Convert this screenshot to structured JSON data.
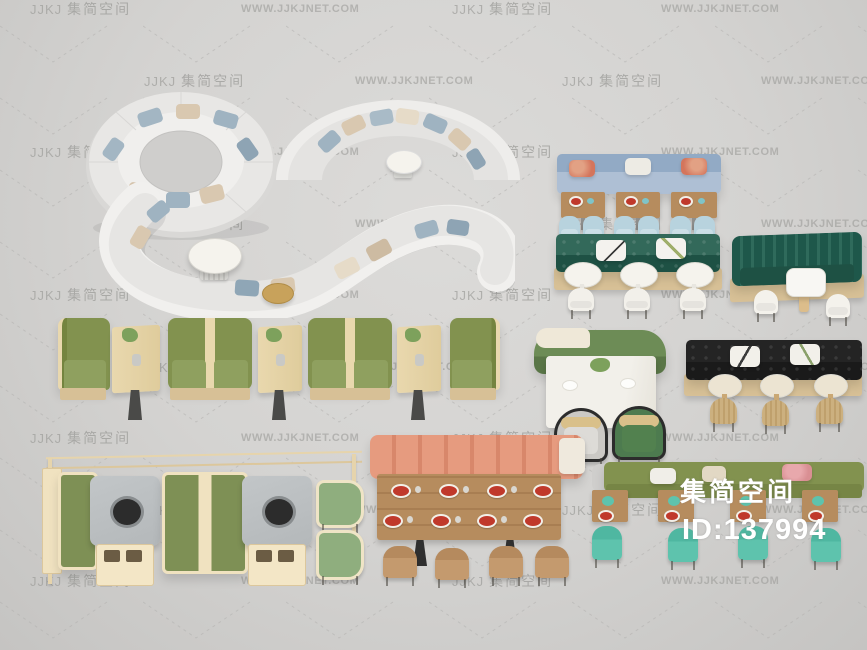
{
  "overlay": {
    "title": "集简空间",
    "id_label": "ID:137994"
  },
  "watermark": {
    "logo": "JJKJ",
    "brand": "集简空间",
    "site": "WWW.JJKJNET.COM",
    "rows": [
      {
        "y": 9,
        "items": [
          {
            "t": "brand",
            "x": 30
          },
          {
            "t": "site",
            "x": 241
          },
          {
            "t": "brand",
            "x": 452
          },
          {
            "t": "site",
            "x": 661
          }
        ]
      },
      {
        "y": 81,
        "items": [
          {
            "t": "brand",
            "x": 144
          },
          {
            "t": "site",
            "x": 355
          },
          {
            "t": "brand",
            "x": 562
          },
          {
            "t": "site",
            "x": 761
          }
        ]
      },
      {
        "y": 152,
        "items": [
          {
            "t": "brand",
            "x": 30
          },
          {
            "t": "site",
            "x": 241
          },
          {
            "t": "brand",
            "x": 452
          },
          {
            "t": "site",
            "x": 661
          }
        ]
      },
      {
        "y": 224,
        "items": [
          {
            "t": "brand",
            "x": 144
          },
          {
            "t": "site",
            "x": 355
          },
          {
            "t": "brand",
            "x": 562
          },
          {
            "t": "site",
            "x": 761
          }
        ]
      },
      {
        "y": 295,
        "items": [
          {
            "t": "brand",
            "x": 30
          },
          {
            "t": "site",
            "x": 241
          },
          {
            "t": "brand",
            "x": 452
          },
          {
            "t": "site",
            "x": 661
          }
        ]
      },
      {
        "y": 367,
        "items": [
          {
            "t": "brand",
            "x": 144
          },
          {
            "t": "site",
            "x": 355
          },
          {
            "t": "brand",
            "x": 562
          },
          {
            "t": "site",
            "x": 761
          }
        ]
      },
      {
        "y": 438,
        "items": [
          {
            "t": "brand",
            "x": 30
          },
          {
            "t": "site",
            "x": 241
          },
          {
            "t": "brand",
            "x": 452
          },
          {
            "t": "site",
            "x": 661
          }
        ]
      },
      {
        "y": 510,
        "items": [
          {
            "t": "brand",
            "x": 144
          },
          {
            "t": "site",
            "x": 355
          },
          {
            "t": "brand",
            "x": 562
          },
          {
            "t": "site",
            "x": 761
          }
        ]
      },
      {
        "y": 581,
        "items": [
          {
            "t": "brand",
            "x": 30
          },
          {
            "t": "site",
            "x": 241
          },
          {
            "t": "brand",
            "x": 452
          },
          {
            "t": "site",
            "x": 661
          }
        ]
      }
    ]
  },
  "palette": {
    "bg1": "#dcdbd9",
    "bg2": "#c5c4c2",
    "wm": "#9e9e9b",
    "sofa": "#e7e6e4",
    "sofaHi": "#f0efed",
    "sofaSh": "#d2d1cf",
    "pilBlue": "#9fb3c1",
    "pilBeige": "#d9c8b0",
    "pilCream": "#eadfcd",
    "blueBack": "#92aac5",
    "blueSeat": "#aebfd4",
    "blueChair": "#b8d3de",
    "wood": "#b68c5e",
    "woodLight": "#e9d8ae",
    "woodBase": "#d7c096",
    "tealGreen": "#2b6052",
    "tealDark": "#1e5144",
    "olive": "#82924f",
    "oliveSeat": "#8fa05f",
    "salmon": "#e69b7f",
    "black": "#1a1a1a",
    "marble": "#b4b8ba",
    "mint": "#5ec3ad",
    "rattan": "#ccb07f",
    "whiteTbl": "#f5f3ed",
    "gold": "#c8a25b",
    "greenChair": "#4d7b4f",
    "cream": "#f1e4c4",
    "clothTbl": "#f2f0ea",
    "overlay": "#ffffff"
  }
}
